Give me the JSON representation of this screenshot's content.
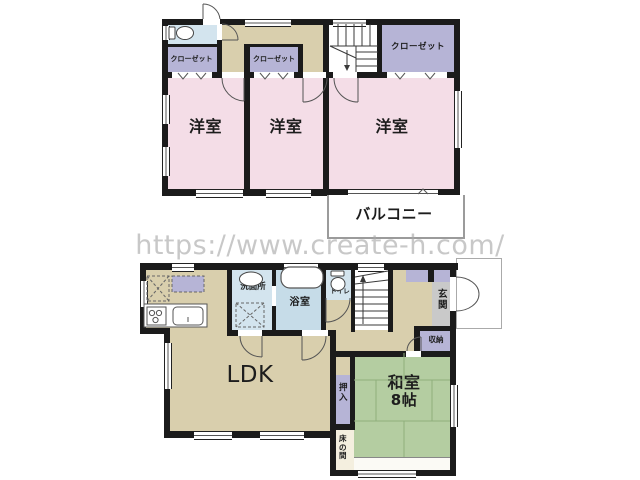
{
  "watermark_url": "https://www.create-h.com/",
  "second_floor": {
    "rooms": [
      {
        "id": "closet-1",
        "label": "クローゼット"
      },
      {
        "id": "closet-2",
        "label": "クローゼット"
      },
      {
        "id": "closet-3",
        "label": "クローゼット"
      },
      {
        "id": "western-room-1",
        "label": "洋室"
      },
      {
        "id": "western-room-2",
        "label": "洋室"
      },
      {
        "id": "western-room-3",
        "label": "洋室"
      },
      {
        "id": "balcony",
        "label": "バルコニー"
      }
    ]
  },
  "first_floor": {
    "rooms": [
      {
        "id": "washroom",
        "label": "洗面所"
      },
      {
        "id": "bathroom",
        "label": "浴室"
      },
      {
        "id": "toilet",
        "label": "トイレ"
      },
      {
        "id": "entrance",
        "label": "玄関"
      },
      {
        "id": "storage",
        "label": "収納"
      },
      {
        "id": "ldk",
        "label": "LDK"
      },
      {
        "id": "japanese-room",
        "label": "和室",
        "size_label": "8帖"
      },
      {
        "id": "oshiire-closet",
        "label": "押入"
      },
      {
        "id": "tokonoma",
        "label": "床の間"
      }
    ]
  },
  "colors": {
    "wall": "#1b1b1b",
    "western_room": "#f4dde7",
    "closet": "#b6b4d6",
    "hallway": "#d9cfad",
    "wet_area": "#d3e4ee",
    "bathroom": "#c6dce8",
    "tatami": "#b4cda1",
    "entrance_floor": "#c9c9c9",
    "tokonoma": "#f4efdf",
    "watermark_text": "#a8a8a8"
  }
}
